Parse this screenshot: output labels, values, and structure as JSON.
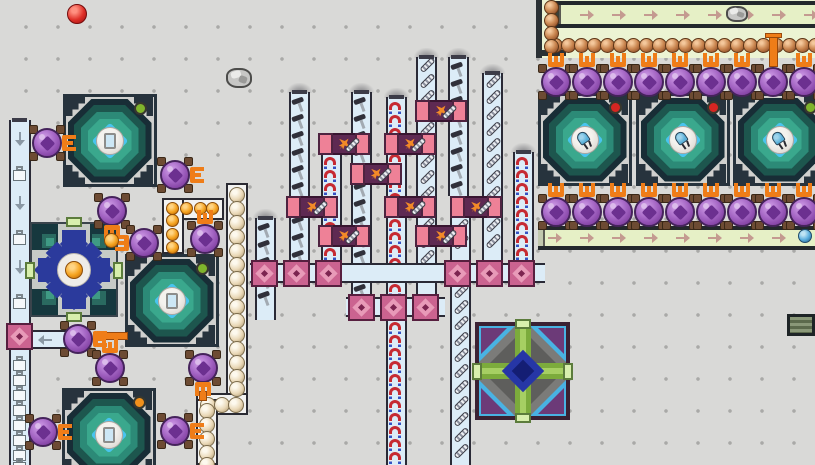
{
  "canvas": {
    "w": 815,
    "h": 465,
    "bg": "#d9d9d7",
    "dot_color": "#a9a9a7",
    "dot_grid": 32
  },
  "colors": {
    "belt_fill": "#dcecf7",
    "belt_edge": "#2a2a36",
    "green_lane": "#e6f0c6",
    "green_edge": "#23282c",
    "green_arrow": "#c49a90",
    "gray_arrow": "#8a98a4",
    "claw_orange": "#ef7d18",
    "pipe_orange": "#ef7d18",
    "pot_purple": "#a263c2",
    "pot_feet": "#6d4b33",
    "assembler_pink": "#ee8197",
    "assembler_core": "#5e2952",
    "crossing_pink": "#cb6390",
    "magnet_red": "#c62a32",
    "magnet_blue": "#3452c4",
    "machine_ring_dark": "#182d36",
    "machine_ring_teal": "#2c8a77",
    "machine_diamond_cyan": "#49c4ee",
    "dot_red": "#d62622",
    "dot_green": "#7fb42c",
    "dot_orange": "#f0901c",
    "crafter_navy": "#2b3a9c",
    "mosaic_green": "#7cab3c",
    "mosaic_blue": "#2636a6",
    "mosaic_cyan": "#49b2e2"
  },
  "item_spacing": {
    "magnet": 13,
    "screw": 16,
    "hammer": 17
  },
  "scene": {
    "rocks": [
      [
        226,
        66,
        26,
        22
      ],
      [
        726,
        4,
        22,
        18
      ]
    ],
    "loose_items": [
      {
        "kind": "red",
        "x": 67,
        "y": 4,
        "d": 20
      },
      {
        "kind": "orange",
        "x": 104,
        "y": 233,
        "d": 15
      },
      {
        "kind": "blue",
        "x": 798,
        "y": 229,
        "d": 14
      }
    ],
    "big_machines": [
      {
        "id": "reactor-top-left",
        "x": 63,
        "y": 94,
        "dot": "green",
        "icon": "glass"
      },
      {
        "id": "reactor-mid-left",
        "x": 125,
        "y": 254,
        "dot": "green",
        "icon": "glass"
      },
      {
        "id": "reactor-bottom-left",
        "x": 62,
        "y": 388,
        "dot": "orange",
        "icon": "glass"
      },
      {
        "id": "smelter-1",
        "x": 538,
        "y": 93,
        "dot": "red",
        "icon": "led"
      },
      {
        "id": "smelter-2",
        "x": 636,
        "y": 93,
        "dot": "red",
        "icon": "led"
      },
      {
        "id": "smelter-3",
        "x": 733,
        "y": 93,
        "dot": "green",
        "icon": "led"
      }
    ],
    "crafter": {
      "x": 30,
      "y": 222,
      "w": 88,
      "h": 95
    },
    "diamond": {
      "x": 475,
      "y": 322,
      "w": 95,
      "h": 98
    },
    "dark_module": {
      "x": 787,
      "y": 314,
      "w": 28,
      "h": 22
    },
    "belts": {
      "left_vertical": {
        "x": 9,
        "w": 22,
        "y1": 120,
        "y2": 465,
        "arrows_down_y": [
          134,
          198,
          262
        ],
        "boxes_y": [
          166,
          230,
          294,
          356,
          371,
          386,
          401,
          416,
          431,
          446,
          458
        ]
      },
      "left_horizontal": {
        "x": 28,
        "y": 330,
        "w": 40,
        "h": 19,
        "arrow_x": 38
      },
      "mid_vertical": [
        {
          "x": 255,
          "y1": 218,
          "y2": 320,
          "item": "hammer",
          "cap": true
        },
        {
          "x": 289,
          "y1": 92,
          "y2": 263,
          "item": "hammer",
          "cap": true
        },
        {
          "x": 321,
          "y1": 152,
          "y2": 263,
          "item": "magnet",
          "cap": true
        },
        {
          "x": 351,
          "y1": 92,
          "y2": 297,
          "item": "hammer",
          "cap": true
        },
        {
          "x": 386,
          "y1": 97,
          "y2": 297,
          "item": "magnet",
          "cap": true
        },
        {
          "x": 386,
          "y1": 317,
          "y2": 465,
          "item": "magnet",
          "cap": false
        },
        {
          "x": 416,
          "y1": 57,
          "y2": 297,
          "item": "screw",
          "cap": true
        },
        {
          "x": 448,
          "y1": 57,
          "y2": 196,
          "item": "hammer",
          "cap": true
        },
        {
          "x": 450,
          "y1": 218,
          "y2": 263,
          "item": "screw",
          "cap": false
        },
        {
          "x": 450,
          "y1": 283,
          "y2": 465,
          "item": "screw",
          "cap": false
        },
        {
          "x": 482,
          "y1": 73,
          "y2": 263,
          "item": "screw",
          "cap": true
        },
        {
          "x": 513,
          "y1": 152,
          "y2": 263,
          "item": "magnet",
          "cap": true
        }
      ],
      "mid_horizontal": [
        {
          "x": 250,
          "y": 263,
          "w": 295,
          "h": 20
        },
        {
          "x": 346,
          "y": 297,
          "w": 99,
          "h": 20
        }
      ],
      "crossings": [
        [
          6,
          323
        ],
        [
          251,
          260
        ],
        [
          283,
          260
        ],
        [
          315,
          260
        ],
        [
          444,
          260
        ],
        [
          476,
          260
        ],
        [
          508,
          260
        ],
        [
          348,
          294
        ],
        [
          380,
          294
        ],
        [
          412,
          294
        ]
      ]
    },
    "assemblers": [
      {
        "x": 415,
        "y": 100
      },
      {
        "x": 318,
        "y": 133
      },
      {
        "x": 384,
        "y": 133
      },
      {
        "x": 350,
        "y": 163
      },
      {
        "x": 286,
        "y": 196
      },
      {
        "x": 384,
        "y": 196
      },
      {
        "x": 450,
        "y": 196
      },
      {
        "x": 318,
        "y": 225
      },
      {
        "x": 415,
        "y": 225
      }
    ],
    "tubes": [
      {
        "ball": "orange",
        "d": 13,
        "segs": [
          [
            162,
            198,
            62,
            22
          ],
          [
            162,
            198,
            22,
            56
          ]
        ],
        "balls": [
          [
            166,
            202
          ],
          [
            180,
            202
          ],
          [
            194,
            202
          ],
          [
            206,
            202
          ],
          [
            166,
            214
          ],
          [
            166,
            228
          ],
          [
            166,
            241
          ]
        ]
      },
      {
        "ball": "cream",
        "d": 16,
        "segs": [
          [
            226,
            183,
            22,
            216
          ],
          [
            196,
            393,
            52,
            22
          ],
          [
            196,
            399,
            22,
            66
          ]
        ],
        "balls": [
          [
            229,
            187
          ],
          [
            229,
            201
          ],
          [
            229,
            215
          ],
          [
            229,
            229
          ],
          [
            229,
            243
          ],
          [
            229,
            257
          ],
          [
            229,
            271
          ],
          [
            229,
            285
          ],
          [
            229,
            299
          ],
          [
            229,
            313
          ],
          [
            229,
            327
          ],
          [
            229,
            341
          ],
          [
            229,
            355
          ],
          [
            229,
            369
          ],
          [
            229,
            381
          ],
          [
            200,
            397
          ],
          [
            214,
            397
          ],
          [
            228,
            397
          ],
          [
            199,
            403
          ],
          [
            199,
            417
          ],
          [
            199,
            431
          ],
          [
            199,
            445
          ],
          [
            199,
            457
          ]
        ]
      }
    ],
    "green_block": {
      "bg": [
        542,
        0,
        273,
        58
      ],
      "left_bar": [
        536,
        0,
        6,
        58
      ],
      "lip": [
        536,
        50,
        30,
        6
      ]
    },
    "green_belts": [
      {
        "x": 554,
        "y": 1,
        "w": 261,
        "h": 27,
        "arrow_xs": [
          580,
          612,
          644,
          676,
          708,
          740,
          772,
          804
        ],
        "cap": "#3a4038"
      },
      {
        "x": 538,
        "y": 226,
        "w": 277,
        "h": 24,
        "arrow_xs": [
          548,
          580,
          612,
          644,
          676,
          708,
          740,
          772
        ],
        "cap": "#c2c8ae"
      }
    ],
    "copper_row": {
      "x0": 548,
      "y": 38,
      "n": 21,
      "step": 13,
      "d": 15
    },
    "copper_col": {
      "x": 544,
      "ys": [
        0,
        13,
        26,
        39
      ],
      "d": 15
    },
    "pipes": [
      [
        93,
        332,
        35,
        8
      ],
      [
        769,
        36,
        9,
        31
      ],
      [
        199,
        391,
        8,
        10
      ]
    ],
    "pipe_caps": [
      [
        765,
        33,
        17,
        5
      ]
    ],
    "pots": [
      {
        "x": 32,
        "y": 128,
        "claw": "right"
      },
      {
        "x": 160,
        "y": 160,
        "claw": "right"
      },
      {
        "x": 97,
        "y": 196,
        "claw": "down"
      },
      {
        "x": 129,
        "y": 228,
        "claw": "left"
      },
      {
        "x": 190,
        "y": 224,
        "claw": "up"
      },
      {
        "x": 63,
        "y": 324,
        "claw": "right"
      },
      {
        "x": 95,
        "y": 353,
        "claw": "up"
      },
      {
        "x": 188,
        "y": 353,
        "claw": "down"
      },
      {
        "x": 28,
        "y": 417,
        "claw": "right"
      },
      {
        "x": 160,
        "y": 416,
        "claw": "right"
      },
      {
        "x": 541,
        "y": 67,
        "claw": "up"
      },
      {
        "x": 572,
        "y": 67,
        "claw": "up"
      },
      {
        "x": 603,
        "y": 67,
        "claw": "up"
      },
      {
        "x": 634,
        "y": 67,
        "claw": "up"
      },
      {
        "x": 665,
        "y": 67,
        "claw": "up"
      },
      {
        "x": 696,
        "y": 67,
        "claw": "up"
      },
      {
        "x": 727,
        "y": 67,
        "claw": "up"
      },
      {
        "x": 758,
        "y": 67,
        "claw": "none"
      },
      {
        "x": 789,
        "y": 67,
        "claw": "up"
      },
      {
        "x": 541,
        "y": 197,
        "claw": "up"
      },
      {
        "x": 572,
        "y": 197,
        "claw": "up"
      },
      {
        "x": 603,
        "y": 197,
        "claw": "up"
      },
      {
        "x": 634,
        "y": 197,
        "claw": "up"
      },
      {
        "x": 665,
        "y": 197,
        "claw": "up"
      },
      {
        "x": 696,
        "y": 197,
        "claw": "up"
      },
      {
        "x": 727,
        "y": 197,
        "claw": "up"
      },
      {
        "x": 758,
        "y": 197,
        "claw": "up"
      },
      {
        "x": 789,
        "y": 197,
        "claw": "up"
      }
    ]
  }
}
